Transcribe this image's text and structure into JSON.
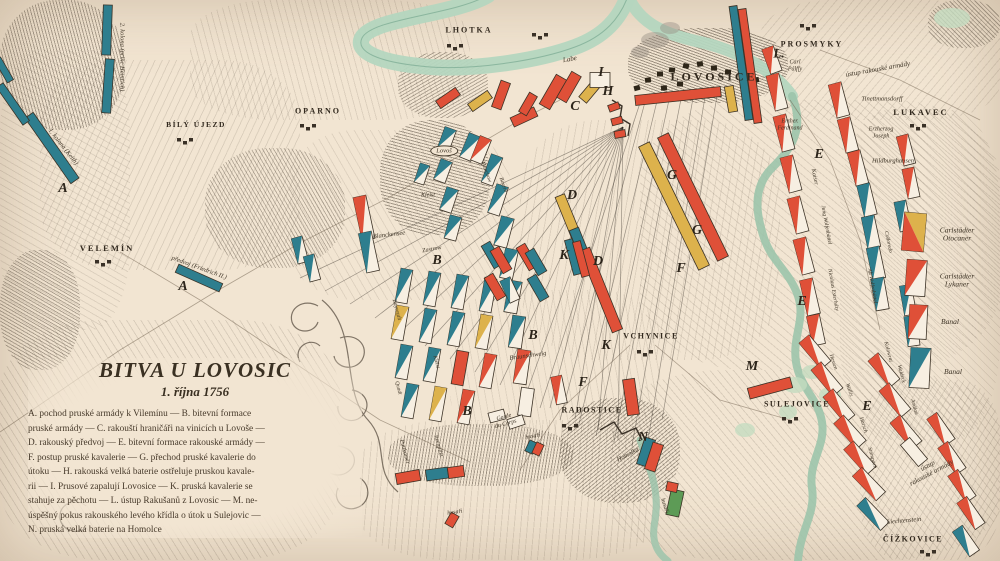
{
  "meta": {
    "map_name": "Bitva u Lovosic — historická mapa"
  },
  "colors": {
    "paper": "#f2e5d2",
    "ink": "#372e24",
    "prussian_teal": "#2e7e8e",
    "austrian_red": "#df5038",
    "yellow": "#ddb24c",
    "green_unit": "#5d9b56",
    "river_green": "#b4d6bf",
    "white_unit": "#f7efe2"
  },
  "title_block": {
    "title": "BITVA U LOVOSIC",
    "date": "1. října 1756",
    "lines": [
      "A. pochod pruské armády k Vilemínu — B. bitevní formace",
      "pruské armády — C. rakouští hraničáři na vinicích u Lovoše —",
      "D. rakouský předvoj — E. bitevní formace rakouské armády —",
      "F. postup pruské kavalerie — G. přechod pruské kavalerie do",
      "útoku — H. rakouská velká baterie ostřeluje pruskou kavale-",
      "rii — I. Prusové zapalují Lovosice — K. pruská kavalerie se",
      "stahuje za pěchotu — L. ústup Rakušanů z Lovosic — M. ne-",
      "úspěšný pokus rakouského levého křídla o útok u Sulejovic —",
      "N. pruská velká baterie na Homolce"
    ]
  },
  "places": [
    [
      "LHOTKA",
      469,
      31,
      8,
      2
    ],
    [
      "PROSMYKY",
      812,
      45,
      8,
      2
    ],
    [
      "LOVOSICE",
      714,
      77,
      12,
      3
    ],
    [
      "LUKAVEC",
      921,
      113,
      8.5,
      2
    ],
    [
      "OPARNO",
      318,
      112,
      8,
      2
    ],
    [
      "BÍLÝ ÚJEZD",
      196,
      125,
      7.5,
      1.5
    ],
    [
      "VELEMÍN",
      107,
      249,
      8.5,
      2
    ],
    [
      "VCHYNICE",
      651,
      337,
      8,
      1.5
    ],
    [
      "RADOSTICE",
      592,
      411,
      8,
      1.5
    ],
    [
      "SULEJOVICE",
      797,
      405,
      8,
      1.5
    ],
    [
      "ČÍŽKOVICE",
      913,
      540,
      8,
      1.5
    ]
  ],
  "letters": [
    [
      "A",
      63,
      189
    ],
    [
      "A",
      183,
      287
    ],
    [
      "B",
      437,
      261
    ],
    [
      "B",
      533,
      336
    ],
    [
      "B",
      467,
      412
    ],
    [
      "C",
      575,
      107
    ],
    [
      "D",
      572,
      196
    ],
    [
      "D",
      598,
      262
    ],
    [
      "E",
      819,
      155
    ],
    [
      "E",
      802,
      302
    ],
    [
      "E",
      867,
      407
    ],
    [
      "F",
      681,
      269
    ],
    [
      "F",
      583,
      383
    ],
    [
      "G",
      672,
      176
    ],
    [
      "G",
      697,
      231
    ],
    [
      "H",
      608,
      92
    ],
    [
      "I",
      601,
      73
    ],
    [
      "K",
      564,
      256
    ],
    [
      "K",
      606,
      346
    ],
    [
      "L.",
      779,
      54
    ],
    [
      "M",
      752,
      367
    ],
    [
      "N",
      643,
      438
    ]
  ],
  "map_labels": [
    [
      "2. kolona (princ Heinrich)",
      122,
      57,
      90,
      6.5,
      0
    ],
    [
      "1. kolona (Keith)",
      63,
      147,
      52,
      6.5,
      0
    ],
    [
      "předvoj (Friedrich II.)",
      199,
      268,
      20,
      6.5,
      0
    ],
    [
      "Labe",
      570,
      60,
      -10,
      7,
      0
    ],
    [
      "Lovoš",
      444,
      151,
      0,
      6.5,
      1
    ],
    [
      "Kleist",
      428,
      196,
      0,
      6,
      0
    ],
    [
      "Blanckensee",
      389,
      235,
      -7,
      6.5,
      0
    ],
    [
      "Zastrow",
      432,
      250,
      -10,
      6,
      0
    ],
    [
      "Quadt",
      398,
      388,
      75,
      5.5,
      0
    ],
    [
      "Bayreuth",
      396,
      310,
      75,
      6,
      0
    ],
    [
      "Kleist",
      436,
      362,
      75,
      5.5,
      0
    ],
    [
      "Münchow",
      486,
      172,
      70,
      5.5,
      0
    ],
    [
      "Bevern",
      503,
      185,
      70,
      5.5,
      0
    ],
    [
      "Braunschweig",
      528,
      356,
      -8,
      6.5,
      0
    ],
    [
      "Itzenplitz",
      438,
      446,
      75,
      6,
      0
    ],
    [
      "Puttkamer",
      404,
      452,
      75,
      6,
      0
    ],
    [
      "Garde\ndu Corps",
      505,
      421,
      -15,
      6,
      0
    ],
    [
      "husaři",
      533,
      437,
      -10,
      6,
      0
    ],
    [
      "husaři",
      455,
      513,
      -8,
      6,
      0
    ],
    [
      "husaři",
      664,
      506,
      72,
      6,
      0
    ],
    [
      "Homolka",
      628,
      455,
      -28,
      6.5,
      0
    ],
    [
      "ústup rakouské armády",
      878,
      70,
      -10,
      7,
      0
    ],
    [
      "ústup\nrakouské armády",
      930,
      470,
      -28,
      7,
      0
    ],
    [
      "Carl\nPálffy",
      795,
      66,
      0,
      6,
      0
    ],
    [
      "Erzher.\nFerdinand",
      790,
      125,
      0,
      6,
      0
    ],
    [
      "Tinettmansdorff",
      882,
      99,
      0,
      6.5,
      0
    ],
    [
      "Erzherzog\nJoseph",
      881,
      133,
      0,
      6,
      0
    ],
    [
      "Hildburghausen",
      893,
      161,
      0,
      6.5,
      0
    ],
    [
      "Kaiser",
      814,
      177,
      78,
      6,
      0
    ],
    [
      "Jung Wolfenbüttel",
      826,
      225,
      80,
      5.5,
      0
    ],
    [
      "Nicolaus Esterházy",
      833,
      290,
      80,
      5.5,
      0
    ],
    [
      "Colloredo",
      888,
      242,
      78,
      5.5,
      0
    ],
    [
      "Alt Wolfenbüttel",
      872,
      286,
      80,
      5.5,
      0
    ],
    [
      "Hessen",
      833,
      362,
      72,
      5.5,
      0
    ],
    [
      "Wallis",
      849,
      390,
      72,
      5.5,
      0
    ],
    [
      "Harsch",
      863,
      425,
      72,
      5.5,
      0
    ],
    [
      "Stampach",
      872,
      458,
      75,
      5.5,
      0
    ],
    [
      "Kolowrat",
      888,
      352,
      75,
      5.5,
      0
    ],
    [
      "Waldeck",
      901,
      374,
      75,
      5.5,
      0
    ],
    [
      "Andlau",
      914,
      407,
      75,
      5.5,
      0
    ],
    [
      "Liechtenstein",
      904,
      521,
      -5,
      6.5,
      0
    ]
  ],
  "legend": {
    "items": [
      {
        "sym": [
          914,
          232,
          22,
          38,
          5,
          "ry"
        ],
        "label": "Carlstädter\nOtocaner",
        "lx": 957,
        "ly": 235
      },
      {
        "sym": [
          916,
          278,
          20,
          36,
          4,
          "wr"
        ],
        "label": "Carlstädter\nLykaner",
        "lx": 957,
        "ly": 281
      },
      {
        "sym": [
          918,
          322,
          18,
          34,
          3,
          "wr"
        ],
        "label": "Banal",
        "lx": 950,
        "ly": 322
      },
      {
        "sym": [
          920,
          368,
          20,
          40,
          3,
          "wt"
        ],
        "label": "Banal",
        "lx": 953,
        "ly": 372
      }
    ]
  },
  "units": [
    [
      107,
      30,
      9,
      50,
      2,
      "t"
    ],
    [
      108,
      86,
      9,
      54,
      4,
      "t"
    ],
    [
      52,
      148,
      10,
      80,
      -35,
      "t"
    ],
    [
      13,
      104,
      8,
      46,
      -35,
      "t"
    ],
    [
      4,
      70,
      7,
      26,
      -30,
      "t"
    ],
    [
      199,
      278,
      48,
      9,
      24,
      "t"
    ],
    [
      447,
      139,
      12,
      22,
      20,
      "wt"
    ],
    [
      443,
      171,
      12,
      22,
      20,
      "wt"
    ],
    [
      449,
      200,
      12,
      24,
      18,
      "wt"
    ],
    [
      453,
      228,
      12,
      24,
      15,
      "wt"
    ],
    [
      422,
      174,
      10,
      20,
      18,
      "wt"
    ],
    [
      470,
      147,
      12,
      26,
      22,
      "wt"
    ],
    [
      481,
      150,
      12,
      26,
      22,
      "wr"
    ],
    [
      492,
      170,
      12,
      30,
      20,
      "wt"
    ],
    [
      498,
      200,
      12,
      30,
      18,
      "wt"
    ],
    [
      504,
      232,
      13,
      30,
      15,
      "wt"
    ],
    [
      509,
      264,
      13,
      30,
      12,
      "wt"
    ],
    [
      513,
      297,
      13,
      32,
      10,
      "wt"
    ],
    [
      517,
      332,
      13,
      32,
      8,
      "wt"
    ],
    [
      522,
      367,
      13,
      34,
      8,
      "wr"
    ],
    [
      526,
      402,
      13,
      28,
      8,
      "w"
    ],
    [
      364,
      218,
      13,
      44,
      -12,
      "wr"
    ],
    [
      369,
      252,
      13,
      40,
      -12,
      "wt"
    ],
    [
      300,
      250,
      11,
      26,
      -15,
      "wt"
    ],
    [
      312,
      268,
      11,
      26,
      -15,
      "wt"
    ],
    [
      404,
      286,
      12,
      34,
      10,
      "wt"
    ],
    [
      432,
      289,
      12,
      34,
      10,
      "wt"
    ],
    [
      460,
      292,
      12,
      34,
      10,
      "wt"
    ],
    [
      488,
      295,
      12,
      34,
      10,
      "wt"
    ],
    [
      400,
      323,
      12,
      34,
      10,
      "wy"
    ],
    [
      428,
      326,
      12,
      34,
      10,
      "wt"
    ],
    [
      456,
      329,
      12,
      34,
      10,
      "wt"
    ],
    [
      484,
      332,
      12,
      34,
      10,
      "wy"
    ],
    [
      404,
      362,
      12,
      34,
      10,
      "wt"
    ],
    [
      432,
      365,
      12,
      34,
      10,
      "wt"
    ],
    [
      460,
      368,
      12,
      34,
      10,
      "r"
    ],
    [
      488,
      371,
      12,
      34,
      10,
      "wr"
    ],
    [
      410,
      401,
      12,
      34,
      10,
      "wt"
    ],
    [
      438,
      404,
      12,
      34,
      10,
      "wy"
    ],
    [
      466,
      407,
      12,
      34,
      10,
      "wr"
    ],
    [
      492,
      255,
      10,
      26,
      -30,
      "t"
    ],
    [
      501,
      260,
      10,
      26,
      -30,
      "r"
    ],
    [
      527,
      257,
      10,
      26,
      -30,
      "r"
    ],
    [
      536,
      262,
      10,
      26,
      -30,
      "t"
    ],
    [
      495,
      287,
      10,
      26,
      -30,
      "r"
    ],
    [
      538,
      288,
      10,
      26,
      -30,
      "t"
    ],
    [
      510,
      290,
      11,
      24,
      -25,
      "wt"
    ],
    [
      497,
      416,
      16,
      10,
      -15,
      "w"
    ],
    [
      516,
      422,
      16,
      10,
      -18,
      "w"
    ],
    [
      408,
      477,
      24,
      11,
      -10,
      "r"
    ],
    [
      437,
      474,
      22,
      11,
      -8,
      "t"
    ],
    [
      456,
      472,
      16,
      11,
      -8,
      "r"
    ],
    [
      531,
      447,
      8,
      12,
      25,
      "t"
    ],
    [
      538,
      449,
      8,
      12,
      25,
      "r"
    ],
    [
      452,
      520,
      9,
      13,
      30,
      "r"
    ],
    [
      675,
      503,
      13,
      26,
      12,
      "g"
    ],
    [
      672,
      487,
      11,
      9,
      12,
      "r"
    ],
    [
      646,
      452,
      11,
      28,
      18,
      "t"
    ],
    [
      654,
      457,
      11,
      28,
      18,
      "r"
    ],
    [
      559,
      390,
      11,
      28,
      -12,
      "wr"
    ],
    [
      631,
      397,
      12,
      36,
      -8,
      "r"
    ],
    [
      448,
      98,
      24,
      9,
      -35,
      "r"
    ],
    [
      480,
      101,
      24,
      9,
      -35,
      "y"
    ],
    [
      501,
      95,
      10,
      28,
      20,
      "r"
    ],
    [
      524,
      117,
      26,
      10,
      -25,
      "r"
    ],
    [
      553,
      92,
      12,
      34,
      30,
      "r"
    ],
    [
      569,
      87,
      11,
      30,
      30,
      "r"
    ],
    [
      591,
      90,
      10,
      26,
      40,
      "y"
    ],
    [
      528,
      104,
      9,
      22,
      30,
      "r"
    ],
    [
      614,
      107,
      11,
      7,
      -20,
      "r"
    ],
    [
      617,
      121,
      11,
      7,
      -15,
      "r"
    ],
    [
      620,
      134,
      11,
      7,
      -10,
      "r"
    ],
    [
      678,
      96,
      86,
      10,
      -6,
      "r"
    ],
    [
      600,
      80,
      20,
      15,
      0,
      "w"
    ],
    [
      693,
      197,
      12,
      137,
      -26,
      "r"
    ],
    [
      674,
      206,
      12,
      137,
      -26,
      "y"
    ],
    [
      568,
      216,
      10,
      44,
      -22,
      "y"
    ],
    [
      579,
      242,
      10,
      28,
      -22,
      "t"
    ],
    [
      601,
      290,
      11,
      88,
      -22,
      "r"
    ],
    [
      573,
      257,
      8,
      36,
      -15,
      "t"
    ],
    [
      581,
      259,
      8,
      36,
      -15,
      "r"
    ],
    [
      741,
      63,
      8,
      115,
      -8,
      "t"
    ],
    [
      750,
      66,
      8,
      115,
      -8,
      "r"
    ],
    [
      731,
      99,
      9,
      26,
      -10,
      "y"
    ],
    [
      772,
      60,
      12,
      26,
      -20,
      "wr"
    ],
    [
      777,
      92,
      13,
      36,
      -15,
      "wr"
    ],
    [
      784,
      133,
      13,
      36,
      -15,
      "wr"
    ],
    [
      791,
      174,
      13,
      36,
      -15,
      "wr"
    ],
    [
      798,
      215,
      13,
      36,
      -15,
      "wr"
    ],
    [
      804,
      256,
      13,
      36,
      -15,
      "wr"
    ],
    [
      810,
      297,
      13,
      36,
      -13,
      "wr"
    ],
    [
      816,
      330,
      13,
      30,
      -12,
      "wr"
    ],
    [
      839,
      100,
      13,
      34,
      -15,
      "wr"
    ],
    [
      848,
      135,
      13,
      34,
      -15,
      "wr"
    ],
    [
      858,
      168,
      13,
      34,
      -15,
      "wr"
    ],
    [
      867,
      200,
      13,
      32,
      -14,
      "wt"
    ],
    [
      871,
      232,
      13,
      32,
      -12,
      "wt"
    ],
    [
      876,
      263,
      13,
      32,
      -12,
      "wt"
    ],
    [
      880,
      294,
      13,
      32,
      -10,
      "wt"
    ],
    [
      906,
      150,
      12,
      30,
      -15,
      "wr"
    ],
    [
      911,
      183,
      12,
      30,
      -12,
      "wr"
    ],
    [
      903,
      216,
      12,
      30,
      -12,
      "wt"
    ],
    [
      908,
      300,
      12,
      30,
      -10,
      "wt"
    ],
    [
      912,
      331,
      12,
      30,
      -8,
      "wt"
    ],
    [
      815,
      352,
      13,
      34,
      -40,
      "wr"
    ],
    [
      827,
      379,
      13,
      34,
      -40,
      "wr"
    ],
    [
      839,
      406,
      13,
      34,
      -40,
      "wr"
    ],
    [
      850,
      432,
      13,
      34,
      -42,
      "wr"
    ],
    [
      860,
      458,
      13,
      34,
      -42,
      "wr"
    ],
    [
      869,
      484,
      13,
      34,
      -44,
      "wr"
    ],
    [
      873,
      514,
      12,
      34,
      -44,
      "wt"
    ],
    [
      884,
      370,
      13,
      34,
      -40,
      "wr"
    ],
    [
      895,
      400,
      13,
      34,
      -40,
      "wr"
    ],
    [
      906,
      432,
      13,
      34,
      -40,
      "wr"
    ],
    [
      914,
      452,
      12,
      28,
      -40,
      "w"
    ],
    [
      770,
      388,
      44,
      11,
      -15,
      "r"
    ],
    [
      941,
      429,
      12,
      32,
      -35,
      "wr"
    ],
    [
      952,
      458,
      12,
      32,
      -35,
      "wr"
    ],
    [
      962,
      486,
      12,
      32,
      -35,
      "wr"
    ],
    [
      971,
      513,
      12,
      32,
      -35,
      "wr"
    ],
    [
      966,
      541,
      12,
      30,
      -35,
      "wt"
    ]
  ]
}
